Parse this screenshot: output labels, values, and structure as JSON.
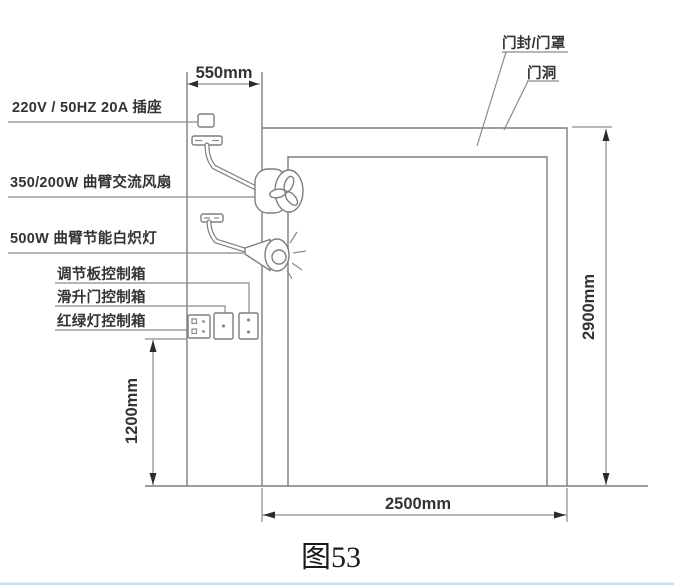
{
  "drawing": {
    "caption": "图53",
    "colors": {
      "line": "#7e7e7e",
      "text": "#333333",
      "arrow": "#2b2b2b",
      "bottom_edge": "#b8cfe6"
    }
  },
  "equipment": {
    "socket_label": "220V / 50HZ 20A 插座",
    "fan_label": "350/200W 曲臂交流风扇",
    "lamp_label": "500W 曲臂节能白炽灯"
  },
  "control_boxes": {
    "regulator_label": "调节板控制箱",
    "sliding_door_label": "滑升门控制箱",
    "traffic_light_label": "红绿灯控制箱"
  },
  "door": {
    "seal_label": "门封/门罩",
    "opening_label": "门洞"
  },
  "dimensions": {
    "wall_offset": "550mm",
    "opening_height": "2900mm",
    "opening_width": "2500mm",
    "mount_height": "1200mm"
  }
}
